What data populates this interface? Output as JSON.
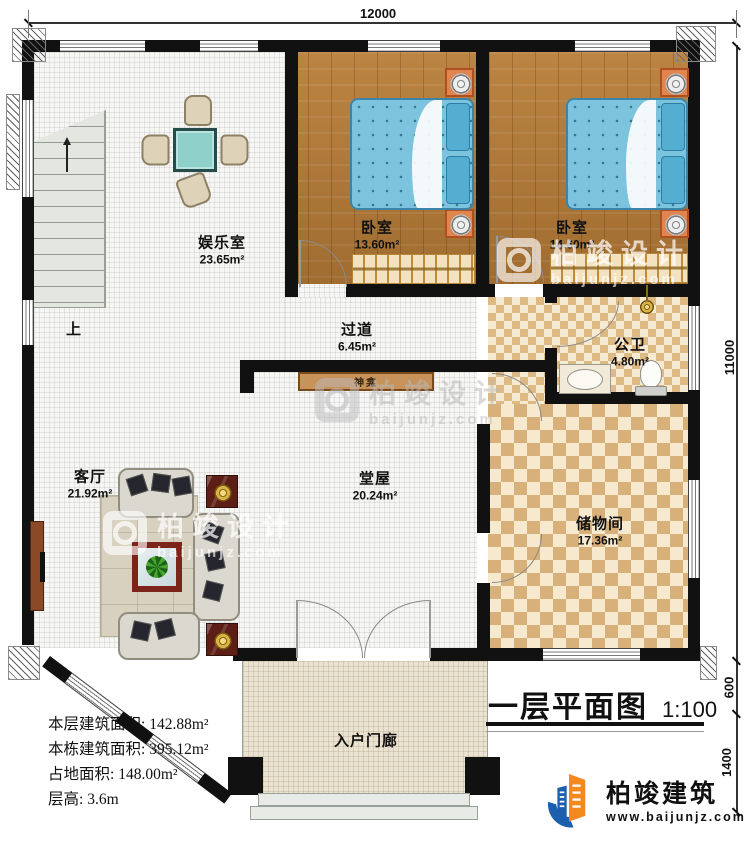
{
  "title_block": {
    "title": "一层平面图",
    "scale": "1:100"
  },
  "dimensions": {
    "top": "12000",
    "right_main": "11000",
    "right_step": "600",
    "right_porch": "1400"
  },
  "rooms": {
    "entertainment": {
      "name": "娱乐室",
      "area": "23.65m²"
    },
    "bedroom1": {
      "name": "卧室",
      "area": "13.60m²"
    },
    "bedroom2": {
      "name": "卧室",
      "area": "14.60m²"
    },
    "bathroom": {
      "name": "公卫",
      "area": "4.80m²"
    },
    "corridor": {
      "name": "过道",
      "area": "6.45m²"
    },
    "hall": {
      "name": "堂屋",
      "area": "20.24m²"
    },
    "living": {
      "name": "客厅",
      "area": "21.92m²"
    },
    "storage": {
      "name": "储物间",
      "area": "17.36m²"
    },
    "porch": {
      "name": "入户门廊"
    }
  },
  "labels": {
    "stairs_up": "上",
    "shrine": "神龛"
  },
  "info": {
    "rows": [
      {
        "label": "本层建筑面积:",
        "value": "142.88m²"
      },
      {
        "label": "本栋建筑面积:",
        "value": "395.12m²"
      },
      {
        "label": "占地面积:",
        "value": "148.00m²"
      },
      {
        "label": "层高:",
        "value": "3.6m"
      }
    ]
  },
  "brand": {
    "name": "柏竣建筑",
    "website": "www.baijunjz.com"
  },
  "watermark": {
    "text": "柏竣设计",
    "subtext": "baijunjz.com"
  },
  "colors": {
    "wall": "#111111",
    "wood": "#b0793a",
    "checker_light": "#f6ead2",
    "checker_dark": "#ddb984",
    "bed_blue": "#7cc4dd",
    "brand_blue": "#1b5fae",
    "brand_orange": "#f28a1e"
  }
}
